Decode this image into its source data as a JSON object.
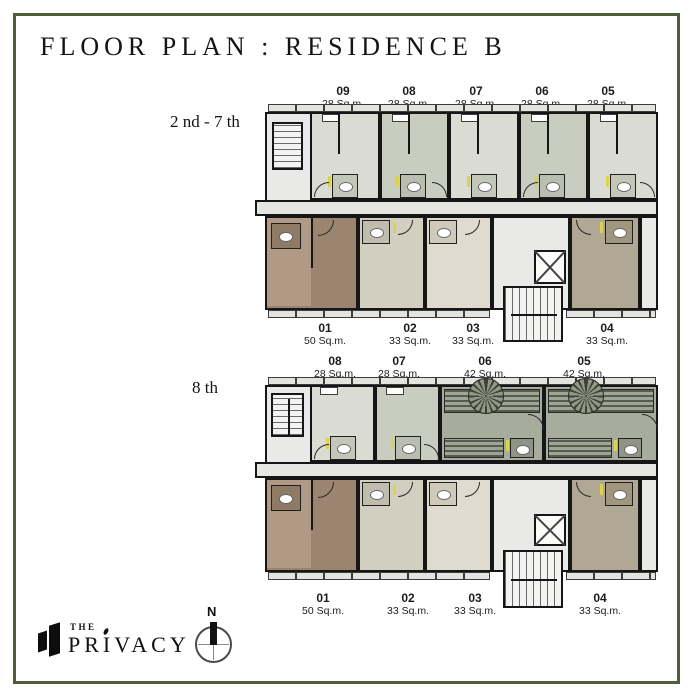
{
  "page": {
    "title": "FLOOR PLAN : RESIDENCE B"
  },
  "plans": [
    {
      "floor_label": "2 nd - 7 th",
      "top_units": [
        {
          "id": "09",
          "area": "28 Sq.m."
        },
        {
          "id": "08",
          "area": "28 Sq.m."
        },
        {
          "id": "07",
          "area": "28 Sq.m."
        },
        {
          "id": "06",
          "area": "28 Sq.m."
        },
        {
          "id": "05",
          "area": "28 Sq.m."
        }
      ],
      "bottom_units": [
        {
          "id": "01",
          "area": "50 Sq.m."
        },
        {
          "id": "02",
          "area": "33 Sq.m."
        },
        {
          "id": "03",
          "area": "33 Sq.m."
        },
        {
          "id": "04",
          "area": "33 Sq.m."
        }
      ]
    },
    {
      "floor_label": "8 th",
      "top_units": [
        {
          "id": "08",
          "area": "28 Sq.m."
        },
        {
          "id": "07",
          "area": "28 Sq.m."
        },
        {
          "id": "06",
          "area": "42 Sq.m."
        },
        {
          "id": "05",
          "area": "42 Sq.m."
        }
      ],
      "bottom_units": [
        {
          "id": "01",
          "area": "50 Sq.m."
        },
        {
          "id": "02",
          "area": "33 Sq.m."
        },
        {
          "id": "03",
          "area": "33 Sq.m."
        },
        {
          "id": "04",
          "area": "33 Sq.m."
        }
      ]
    }
  ],
  "brand": {
    "prefix": "THE",
    "name": "PRIVACY"
  },
  "compass": {
    "north": "N"
  },
  "colors": {
    "frame": "#4d5e38",
    "unit_light": "#dadcd3",
    "unit_mid": "#c9cdc0",
    "corridor": "#e6e7e3",
    "unit_brown_dark": "#9b8470",
    "unit_brown_light": "#b09a86",
    "unit_tan": "#d3cfc0",
    "unit_cream": "#dfdbce",
    "unit_taupe": "#b1a795",
    "unit_sage": "#a8ac9c",
    "accent_yellow": "#d9d44f"
  }
}
